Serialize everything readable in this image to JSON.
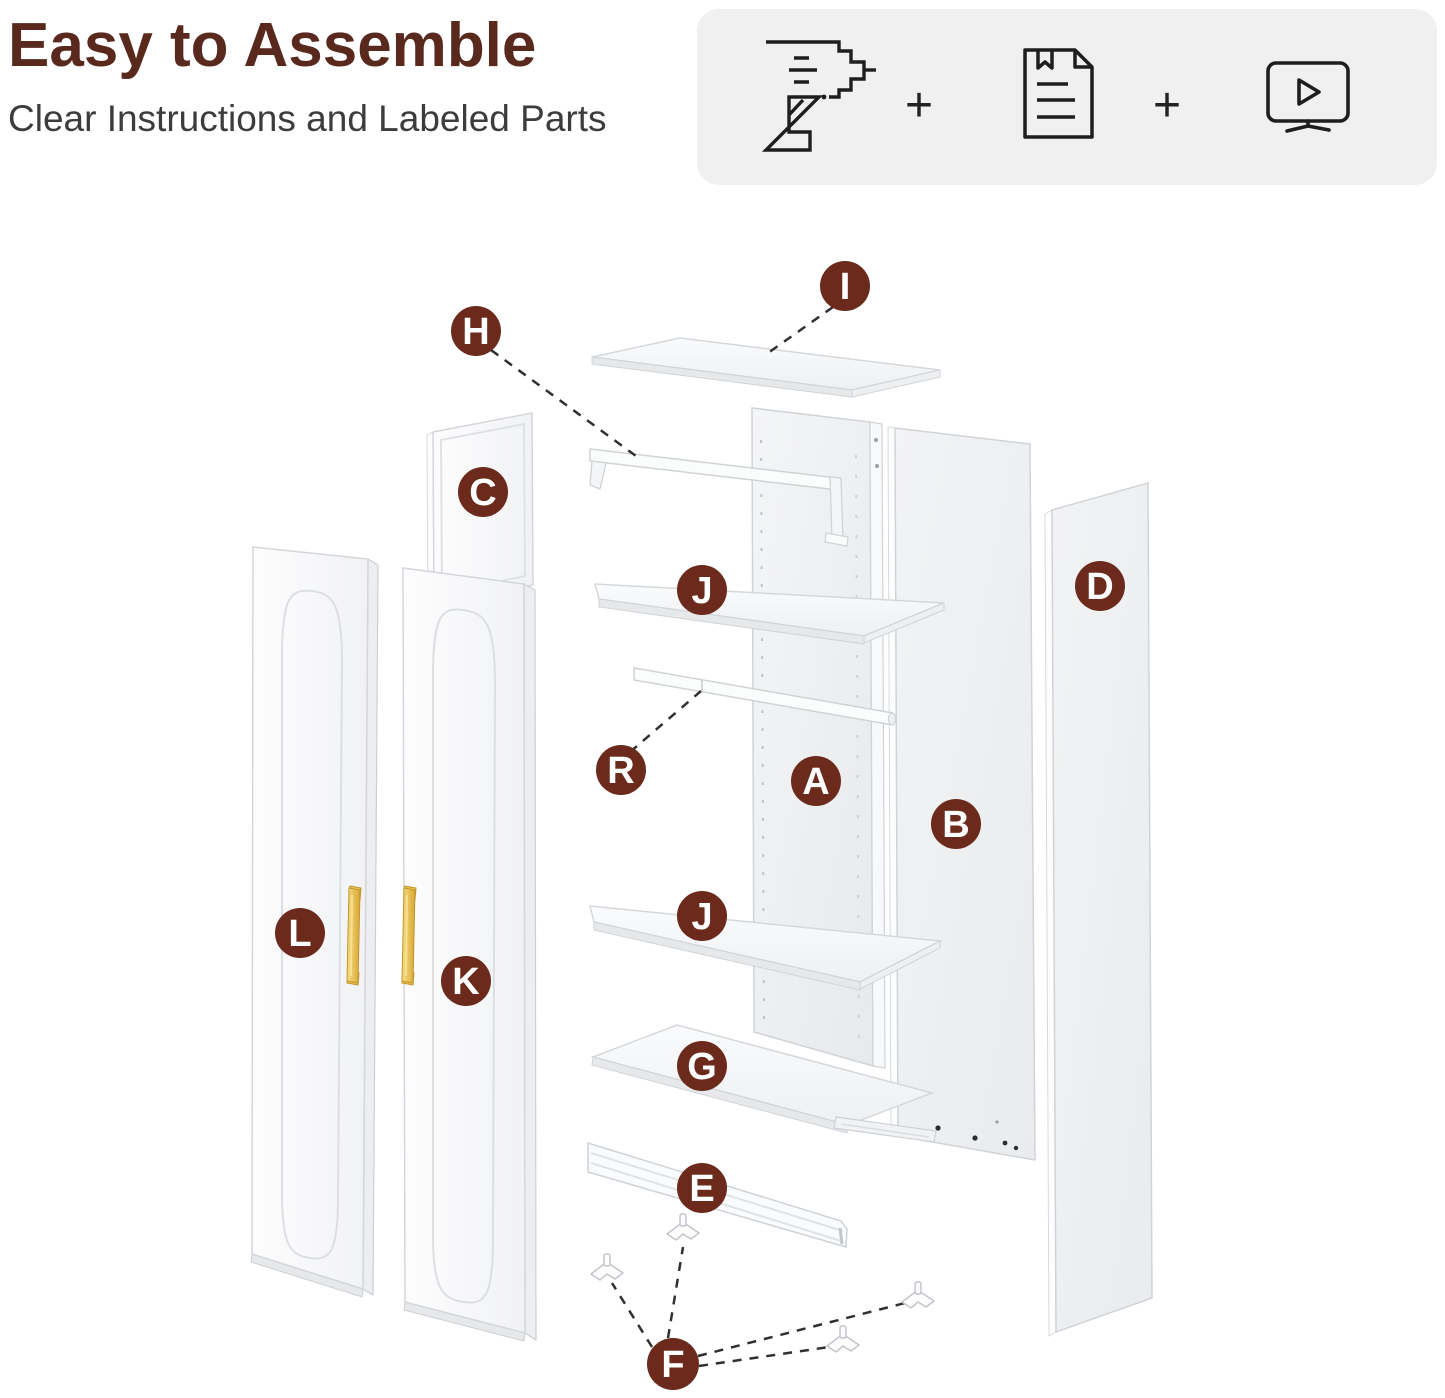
{
  "header": {
    "title": "Easy to Assemble",
    "subtitle": "Clear Instructions and Labeled Parts"
  },
  "toolkit": {
    "plus": "+",
    "icons": [
      "drill-icon",
      "plus-sign",
      "instruction-manual-icon",
      "plus-sign",
      "video-tutorial-icon"
    ]
  },
  "colors": {
    "accent": "#6b2a1b",
    "title": "#5a291e",
    "toolkit_bg": "#f0f0f1",
    "handle_gold": "#e8c24b"
  },
  "diagram": {
    "labels": [
      {
        "id": "I",
        "letter": "I"
      },
      {
        "id": "H",
        "letter": "H"
      },
      {
        "id": "C",
        "letter": "C"
      },
      {
        "id": "J-upper",
        "letter": "J"
      },
      {
        "id": "D",
        "letter": "D"
      },
      {
        "id": "R",
        "letter": "R"
      },
      {
        "id": "A",
        "letter": "A"
      },
      {
        "id": "B",
        "letter": "B"
      },
      {
        "id": "J-lower",
        "letter": "J"
      },
      {
        "id": "L",
        "letter": "L"
      },
      {
        "id": "K",
        "letter": "K"
      },
      {
        "id": "G",
        "letter": "G"
      },
      {
        "id": "E",
        "letter": "E"
      },
      {
        "id": "F",
        "letter": "F"
      }
    ]
  }
}
